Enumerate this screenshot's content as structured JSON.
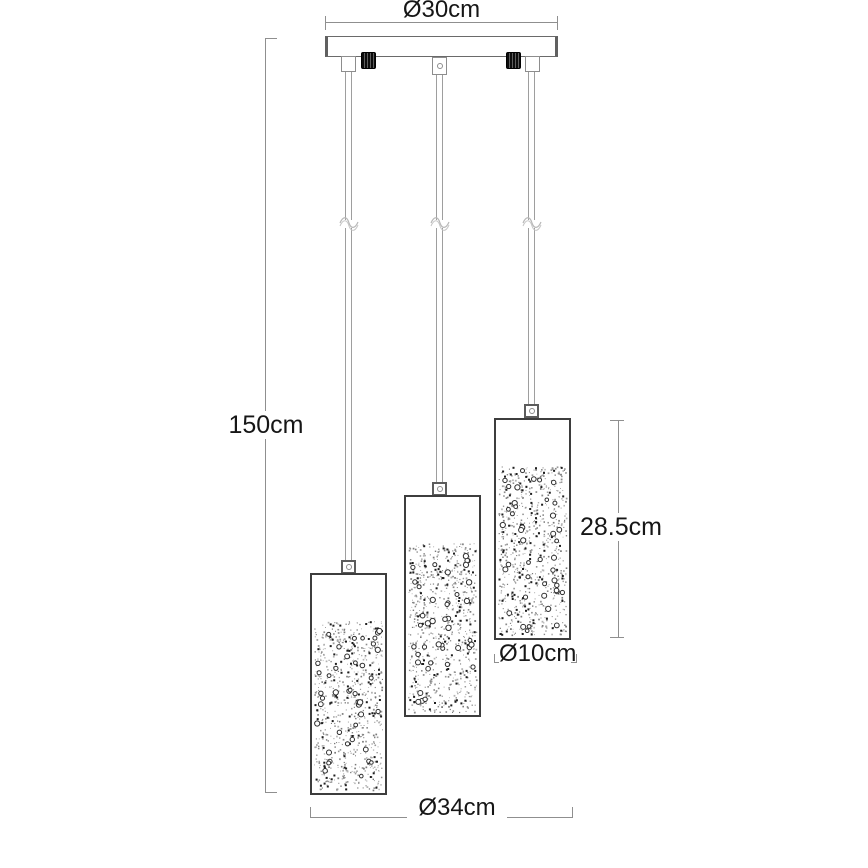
{
  "diagram": {
    "type": "product-dimension-drawing",
    "shade_count": 3,
    "labels": {
      "canopy_diameter": "Ø30cm",
      "total_height": "150cm",
      "shade_height": "28.5cm",
      "shade_diameter": "Ø10cm",
      "fixture_width": "Ø34cm"
    },
    "colors": {
      "dimension_line": "#8f8f8f",
      "object_line": "#3d3d3d",
      "text": "#161616",
      "nut": "#0c0c0c",
      "background": "#ffffff"
    }
  }
}
